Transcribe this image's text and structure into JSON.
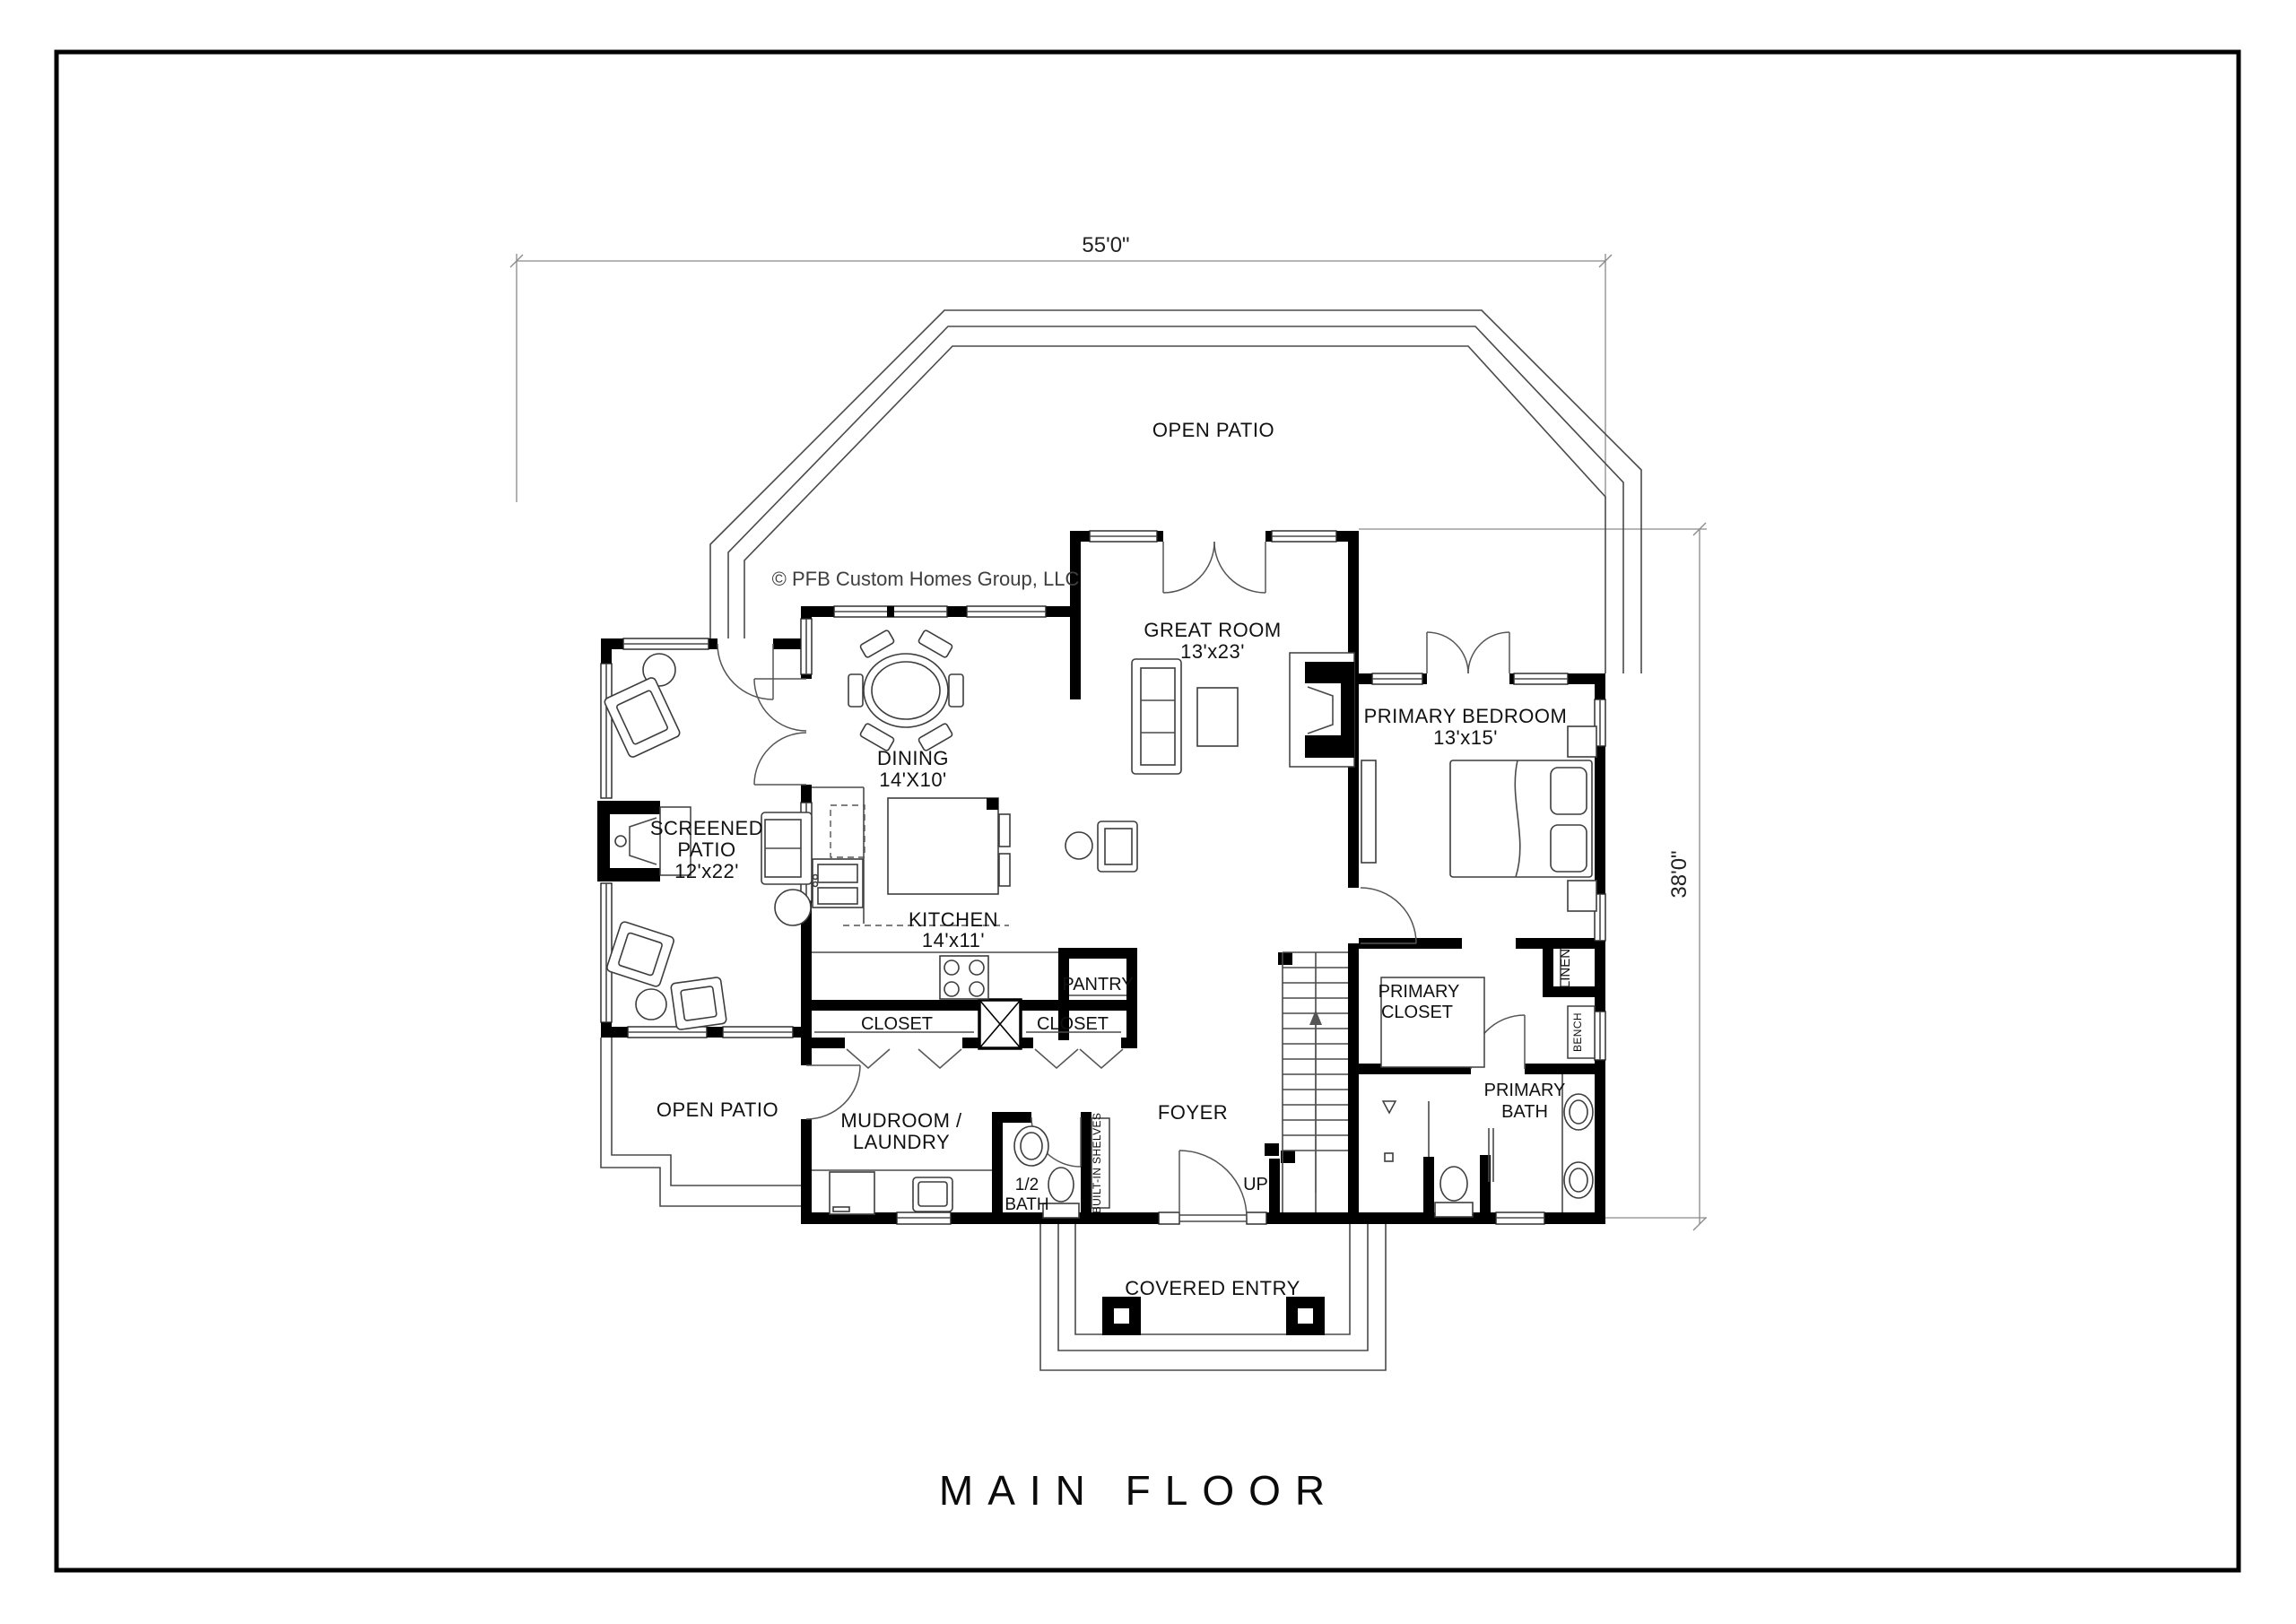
{
  "page": {
    "title": "MAIN FLOOR",
    "copyright": "© PFB Custom Homes Group, LLC",
    "dimensions": {
      "overall_width": "55'0\"",
      "overall_depth": "38'0\""
    },
    "rooms": {
      "open_patio_top": "OPEN PATIO",
      "great_room": "GREAT ROOM",
      "great_room_size": "13'x23'",
      "primary_bedroom": "PRIMARY BEDROOM",
      "primary_bedroom_size": "13'x15'",
      "dining": "DINING",
      "dining_size": "14'X10'",
      "kitchen": "KITCHEN",
      "kitchen_size": "14'x11'",
      "screened_patio_1": "SCREENED",
      "screened_patio_2": "PATIO",
      "screened_patio_size": "12'x22'",
      "pantry": "PANTRY",
      "closet_left": "CLOSET",
      "closet_right": "CLOSET",
      "primary_closet_1": "PRIMARY",
      "primary_closet_2": "CLOSET",
      "linen": "LINEN",
      "bench": "BENCH",
      "open_patio_lower": "OPEN PATIO",
      "mudroom_1": "MUDROOM /",
      "mudroom_2": "LAUNDRY",
      "half_bath_1": "1/2",
      "half_bath_2": "BATH",
      "built_in_shelves": "BUILT-IN SHELVES",
      "foyer": "FOYER",
      "up": "UP",
      "primary_bath_1": "PRIMARY",
      "primary_bath_2": "BATH",
      "covered_entry": "COVERED ENTRY"
    }
  }
}
